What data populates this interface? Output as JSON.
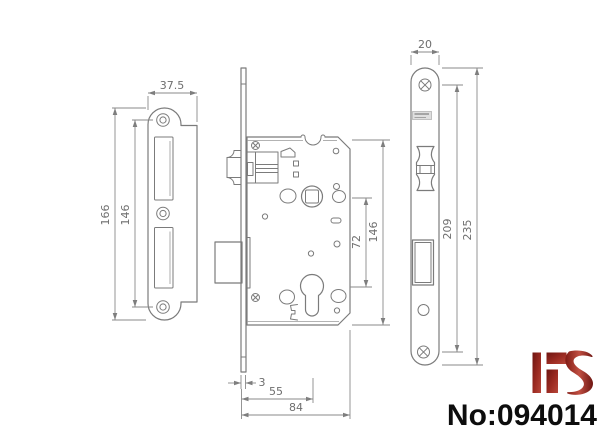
{
  "drawing_title": "mortise-lock-technical-drawing",
  "colors": {
    "line": "#7b7b7b",
    "dimension": "#8a8a8a",
    "dim_text": "#6e6e6e",
    "product_text": "#0d0d0d",
    "logo_dark": "#6e1511",
    "logo_light": "#b8463a"
  },
  "views": {
    "strike_plate": {
      "dim_width": "37.5",
      "dim_height_outer": "166",
      "dim_hole_spacing": "146"
    },
    "lock_body": {
      "dim_center_distance": "72",
      "dim_case_height": "146",
      "dim_faceplate_thickness": "3",
      "dim_backset": "55",
      "dim_case_depth": "84"
    },
    "front_plate": {
      "dim_width": "20",
      "dim_screw_spacing": "209",
      "dim_length": "235"
    }
  },
  "footer": {
    "logo": "HS",
    "product_number": "No:094014"
  }
}
